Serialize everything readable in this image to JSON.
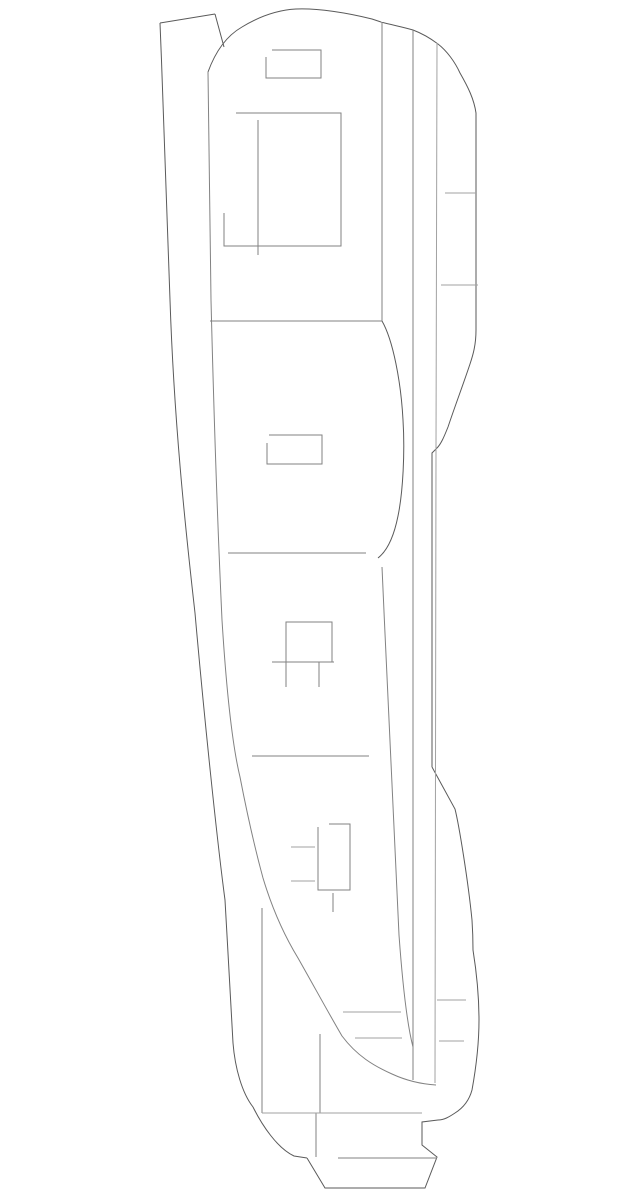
{
  "page": {
    "background": "#ffffff"
  },
  "diagram": {
    "description": "technical-line-drawing-of-body-side-panel",
    "width": 640,
    "height": 1199,
    "stroke_width": 1,
    "palette": {
      "dark": "#5a5a5a",
      "medium": "#828282",
      "light": "#a2a2a2"
    },
    "paths": [
      {
        "name": "left-outer-edge",
        "color": "dark",
        "d": "M160,23 C164,120 167,220 170,300 C174,420 185,525 195,613 C204,715 217,840 225,900 C228,950 231,1013 233,1043 C235,1068 242,1093 253,1107 C262,1125 277,1148 294,1156 L307,1158"
      },
      {
        "name": "strip-top-edge",
        "color": "dark",
        "d": "M160,23 L215,14"
      },
      {
        "name": "strip-right-edge",
        "color": "dark",
        "d": "M215,14 L224,47"
      },
      {
        "name": "top-dome-outline",
        "color": "dark",
        "d": "M208,72 C216,50 228,35 242,27 C260,16 278,10 296,9 C318,8 348,13 372,19 L381,22 C392,25 403,27 413,30 C421,33 430,38 438,44 C447,51 455,62 460,73 C468,87 474,99 476,113 L476,330"
      },
      {
        "name": "right-notch-curve",
        "color": "dark",
        "d": "M476,330 C476,345 473,355 470,364 C463,385 455,406 448,427 C444,437 441,444 437,448 L432,453 L432,767"
      },
      {
        "name": "right-lower-outline",
        "color": "dark",
        "d": "M432,767 L455,809 C459,825 468,880 472,920 C473,935 473,942 473,950 C477,975 479,995 479,1020 C479,1045 476,1068 472,1090 C469,1101 463,1108 455,1113 C449,1117 444,1120 438,1120 L422,1122 L422,1145 L437,1157 L425,1188 L325,1188 L307,1158"
      },
      {
        "name": "left-inner-edge-sweep",
        "color": "medium",
        "d": "M208,72 C209,160 210,235 211,300 C214,420 218,535 222,620 C227,700 233,748 240,777 C246,808 254,845 263,878 C272,908 284,935 298,958 C315,988 328,1012 342,1036 C357,1056 374,1066 392,1074 C405,1080 420,1084 436,1085"
      },
      {
        "name": "slant-line",
        "color": "medium",
        "d": "M382,567 C388,700 394,840 399,935 C403,990 408,1028 413,1047"
      },
      {
        "name": "vertical-line-v1",
        "color": "medium",
        "d": "M382,22 L382,321"
      },
      {
        "name": "vertical-line-v2",
        "color": "medium",
        "d": "M413,30 L413,1080"
      },
      {
        "name": "vertical-line-v3",
        "color": "light",
        "d": "M437,43 L436,450 L435,1083"
      },
      {
        "name": "belt-line",
        "color": "medium",
        "d": "M210,321 L382,321"
      },
      {
        "name": "bulge-curve",
        "color": "dark",
        "d": "M382,321 C393,340 401,382 403,420 C405,452 403,492 398,516 C394,536 387,551 378,558"
      },
      {
        "name": "mid-horizontal-line",
        "color": "medium",
        "d": "M228,553 L366,553"
      },
      {
        "name": "lower-horizontal-line",
        "color": "medium",
        "d": "M252,756 L369,756"
      },
      {
        "name": "top-small-rect",
        "color": "medium",
        "d": "M266,57 L266,78 L321,78 L321,50 L272,50"
      },
      {
        "name": "big-rect",
        "color": "medium",
        "d": "M236,113 L341,113 L341,246 L224,246 L224,213"
      },
      {
        "name": "big-rect-inner-vertical",
        "color": "medium",
        "d": "M258,120 L258,255"
      },
      {
        "name": "mid-small-rect",
        "color": "medium",
        "d": "M269,435 L322,435 L322,464 L267,464 L267,443"
      },
      {
        "name": "mid-square",
        "color": "medium",
        "d": "M286,687 L286,622 L332,622 L332,662"
      },
      {
        "name": "mid-square-horizontal",
        "color": "medium",
        "d": "M272,662 L334,662"
      },
      {
        "name": "mid-square-inner-vertical",
        "color": "medium",
        "d": "M319,662 L319,687"
      },
      {
        "name": "bottom-rect",
        "color": "medium",
        "d": "M318,827 L318,890 L350,890 L350,824 L329,824"
      },
      {
        "name": "bottom-rect-tick-upper",
        "color": "light",
        "d": "M291,847 L315,847"
      },
      {
        "name": "bottom-rect-tick-lower",
        "color": "light",
        "d": "M291,881 L315,881"
      },
      {
        "name": "bottom-rect-tail",
        "color": "medium",
        "d": "M333,893 L333,912"
      },
      {
        "name": "right-tick-upper",
        "color": "light",
        "d": "M445,193 L476,193"
      },
      {
        "name": "right-tick-mid",
        "color": "light",
        "d": "M441,285 L478,285"
      },
      {
        "name": "lower-left-tick-1",
        "color": "light",
        "d": "M343,1012 L401,1012"
      },
      {
        "name": "lower-left-tick-2",
        "color": "light",
        "d": "M355,1038 L402,1038"
      },
      {
        "name": "lower-right-tick-1",
        "color": "light",
        "d": "M437,1000 L466,1000"
      },
      {
        "name": "lower-right-tick-2",
        "color": "light",
        "d": "M439,1041 L464,1041"
      },
      {
        "name": "bottom-vertical-left",
        "color": "medium",
        "d": "M262,908 L262,1113"
      },
      {
        "name": "bottom-vertical-mid-upper",
        "color": "medium",
        "d": "M320,1034 L320,1113"
      },
      {
        "name": "bottom-vertical-mid-lower",
        "color": "medium",
        "d": "M316,1113 L316,1157"
      },
      {
        "name": "bottom-horizontal-wide",
        "color": "light",
        "d": "M262,1113 L422,1113"
      },
      {
        "name": "bottom-inner-horizontal",
        "color": "medium",
        "d": "M338,1158 L437,1158"
      }
    ]
  }
}
